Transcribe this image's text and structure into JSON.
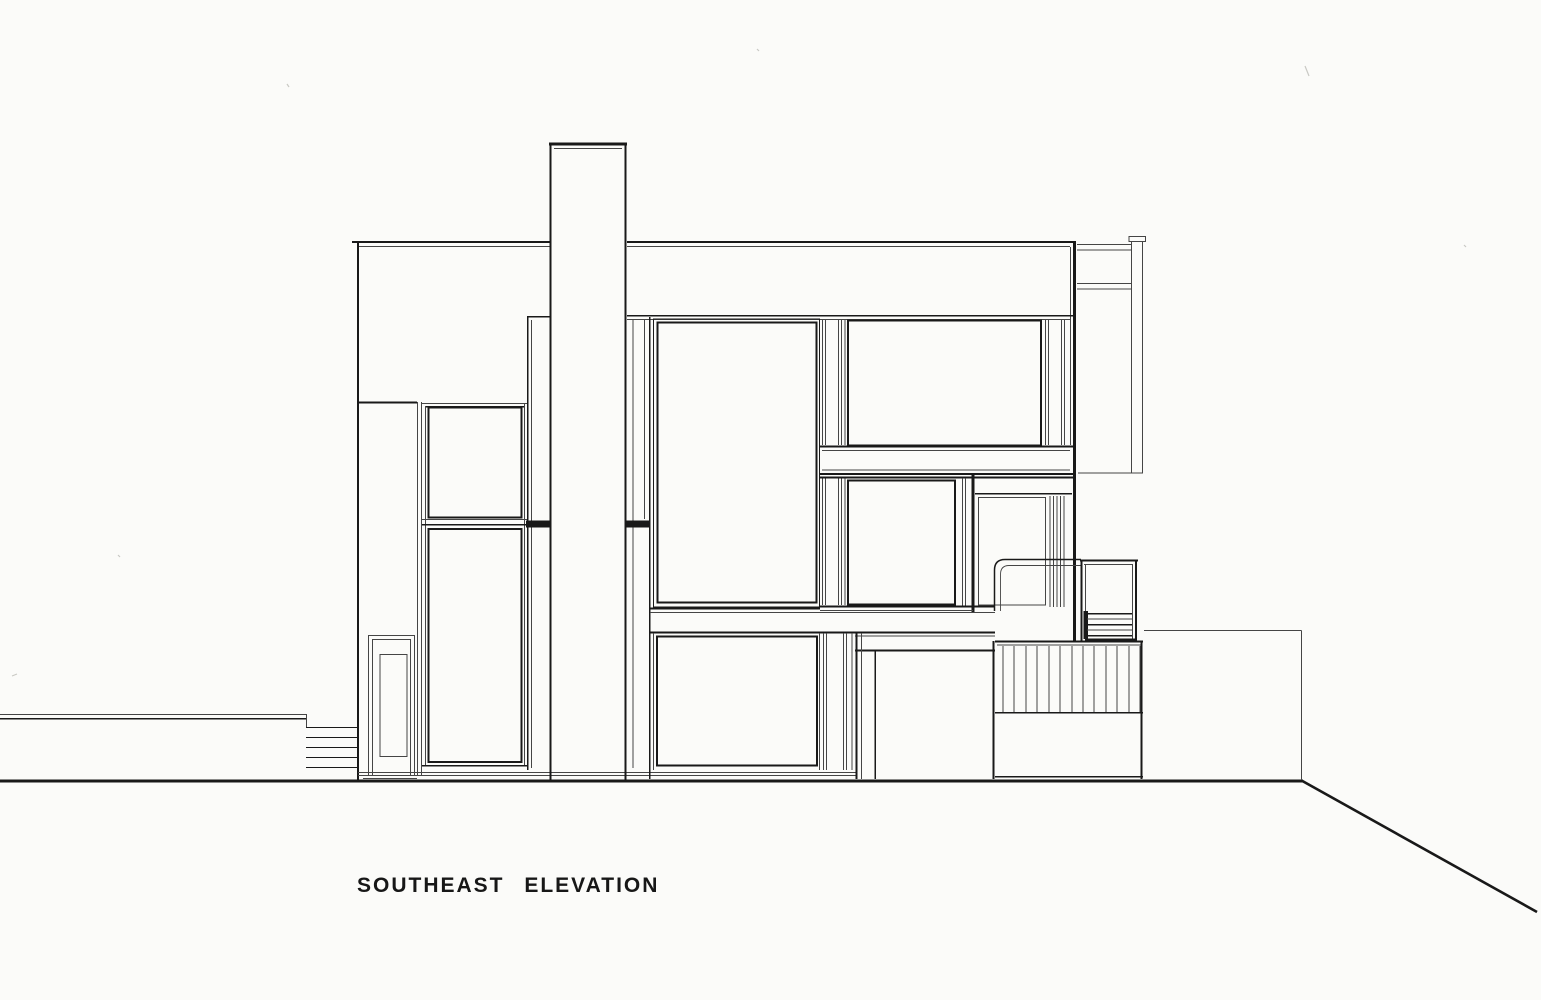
{
  "page": {
    "colors": {
      "paper": "#fbfbf9",
      "ink": "#191919",
      "ink_light": "#454545",
      "faint": "#c9c9c4"
    }
  },
  "caption": {
    "title": "SOUTHEAST ELEVATION"
  }
}
